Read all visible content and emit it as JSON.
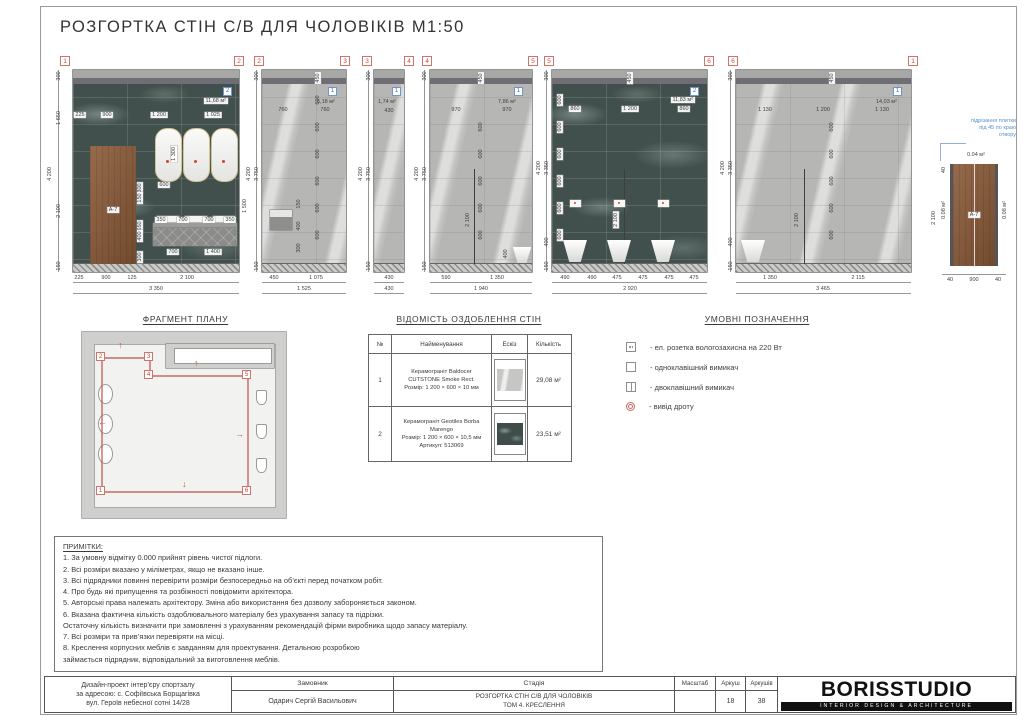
{
  "sheet": {
    "title": "РОЗГОРТКА СТІН С/В ДЛЯ ЧОЛОВІКІВ М1:50"
  },
  "elevations": [
    {
      "id": "1-2",
      "marker_left": "1",
      "marker_right": "2",
      "material_ref": "2",
      "area": "11,68 м²",
      "dims_top": [
        "225",
        "900",
        "1 200",
        "1 025"
      ],
      "dims_left": [
        "300",
        "1 650",
        "2 100",
        "150"
      ],
      "overall": "4 200",
      "dim_right": "1 500",
      "mirror_height": "1 300",
      "mirror_width": "600",
      "door_label": "А-7",
      "door_side": [
        "300",
        "150",
        "650",
        "400",
        "300"
      ],
      "vanity_top": [
        "350",
        "700",
        "700",
        "350"
      ],
      "vanity_bottom": [
        "700",
        "1 400"
      ],
      "dims_bottom": [
        "225",
        "900",
        "125",
        "2 100"
      ],
      "total": "3 350"
    },
    {
      "id": "2-3",
      "marker_left": "2",
      "marker_right": "3",
      "material_ref": "1",
      "area": "6,18 м²",
      "strip": "450",
      "tile": "600",
      "dims_top": [
        "760",
        "760"
      ],
      "dims_left": [
        "300",
        "3 750",
        "150"
      ],
      "overall": "4 200",
      "dryer_dims": [
        "150",
        "400",
        "300"
      ],
      "dims_bottom": [
        "450",
        "1 075"
      ],
      "total": "1 525"
    },
    {
      "id": "3-4",
      "marker_left": "3",
      "marker_right": "4",
      "material_ref": "1",
      "area": "1,74 м²",
      "dims_top": [
        "430"
      ],
      "dims_left": [
        "300",
        "3 750",
        "150"
      ],
      "overall": "4 200",
      "dims_bottom": [
        "430"
      ],
      "total": "430"
    },
    {
      "id": "4-5",
      "marker_left": "4",
      "marker_right": "5",
      "material_ref": "1",
      "area": "7,86 м²",
      "strip": "450",
      "tile": "600",
      "partition": "2 100",
      "urinal_dim": "400",
      "dims_top": [
        "970",
        "970"
      ],
      "dims_left": [
        "300",
        "3 750",
        "150"
      ],
      "overall": "4 200",
      "dims_bottom": [
        "590",
        "1 350"
      ],
      "total": "1 940"
    },
    {
      "id": "5-6",
      "marker_left": "5",
      "marker_right": "6",
      "material_ref": "2",
      "area": "11,83 м²",
      "strip": "450",
      "tile": "600",
      "partition": "2 100",
      "dims_top": [
        "860",
        "1 200",
        "860"
      ],
      "dims_left": [
        "300",
        "3 350",
        "400",
        "150"
      ],
      "overall": "4 200",
      "dims_bottom": [
        "490",
        "490",
        "475",
        "475",
        "475",
        "475"
      ],
      "total": "2 920"
    },
    {
      "id": "6-1",
      "marker_left": "6",
      "marker_right": "1",
      "material_ref": "1",
      "area": "14,03 м²",
      "strip": "450",
      "tile": "600",
      "partition": "2 100",
      "dims_top": [
        "1 130",
        "1 200",
        "1 130"
      ],
      "dims_left": [
        "300",
        "3 350",
        "400",
        "150"
      ],
      "overall": "4 200",
      "dims_bottom": [
        "1 350",
        "2 115"
      ],
      "total": "3 465"
    }
  ],
  "door_detail": {
    "note_lines": [
      "підрізання плитки",
      "під 45 по краю",
      "отвору"
    ],
    "area_top": "0.04 м²",
    "area_side_left": "0.08 м²",
    "area_side_right": "0.08 м²",
    "dim_top_left": "40",
    "height": "2 100",
    "label": "А-7",
    "dims_bottom": [
      "40",
      "900",
      "40"
    ]
  },
  "plan": {
    "title": "ФРАГМЕНТ ПЛАНУ",
    "markers": {
      "p1": "1",
      "p2": "2",
      "p3": "3",
      "p4": "4",
      "p5": "5",
      "p6": "6"
    },
    "arrows": {
      "up": "↑",
      "down": "↓",
      "left": "←",
      "right": "→"
    }
  },
  "finish_table": {
    "title": "ВІДОМІСТЬ ОЗДОБЛЕННЯ СТІН",
    "headers": [
      "№",
      "Найменування",
      "Ескіз",
      "Кількість"
    ],
    "rows": [
      {
        "num": "1",
        "line1": "Керамограніт Baldocer",
        "line2": "CUTSTONE Smoke Rect.",
        "line3": "Розмір: 1 200 × 600 × 10 мм",
        "line4": "",
        "qty": "29,08 м²"
      },
      {
        "num": "2",
        "line1": "Керамограніт Geotiles Borba",
        "line2": "Marengo",
        "line3": "Розмір: 1 200 × 600 × 10,5 мм",
        "line4": "Артикул: 513069",
        "qty": "23,51 м²"
      }
    ]
  },
  "legend": {
    "title": "УМОВНІ ПОЗНАЧЕННЯ",
    "items": [
      {
        "label": "- ел. розетка вологозахисна на 220 Вт"
      },
      {
        "label": "- одноклавішний вимикач"
      },
      {
        "label": "- двоклавішний вимикач"
      },
      {
        "label": "- вивід дроту"
      }
    ]
  },
  "notes": {
    "title": "ПРИМІТКИ:",
    "lines": [
      "1. За умовну відмітку 0.000 прийнят рівень чистої підлоги.",
      "2. Всі розміри вказано у міліметрах, якщо не вказано інше.",
      "3. Всі підрядники повинні перевірити розміри безпосередньо на об’єкті перед початком робіт.",
      "4. Про будь які припущення та розбіжності повідомити архітектора.",
      "5. Авторські права належать архітектору. Зміна або використання без дозволу забороняється законом.",
      "6. Вказана фактична кількість оздоблювального матеріалу без урахування запасу та підрізки.",
      "Остаточну кількість визначити при замовленні з урахуванням рекомендацій фірми виробника щодо запасу матеріалу.",
      "7. Всі розміри та прив’язки перевіряти на місці.",
      "8. Креслення корпусних меблів є завданням для проектування. Детальною розробкою",
      "займається підрядник, відповідальний за виготовлення меблів."
    ]
  },
  "title_block": {
    "project_line1": "Дизайн-проект інтер’єру спортзалу",
    "project_line2": "за адресою: с. Софіївська Борщагівка",
    "project_line3": "вул. Героїв небесної сотні 14/28",
    "client_label": "Замовник",
    "client": "Одарич Сергій Васильович",
    "stage_label": "Стадія",
    "stage_line1": "РОЗГОРТКА СТІН С/В ДЛЯ ЧОЛОВІКІВ",
    "stage_line2": "ТОМ 4. КРЕСЛЕННЯ",
    "scale_label": "Масштаб",
    "scale": "",
    "sheet_label": "Аркуш",
    "sheet": "18",
    "sheets_label": "Аркушів",
    "sheets": "38",
    "logo": "BORISSTUDIO",
    "logo_sub": "INTERIOR DESIGN & ARCHITECTURE"
  }
}
